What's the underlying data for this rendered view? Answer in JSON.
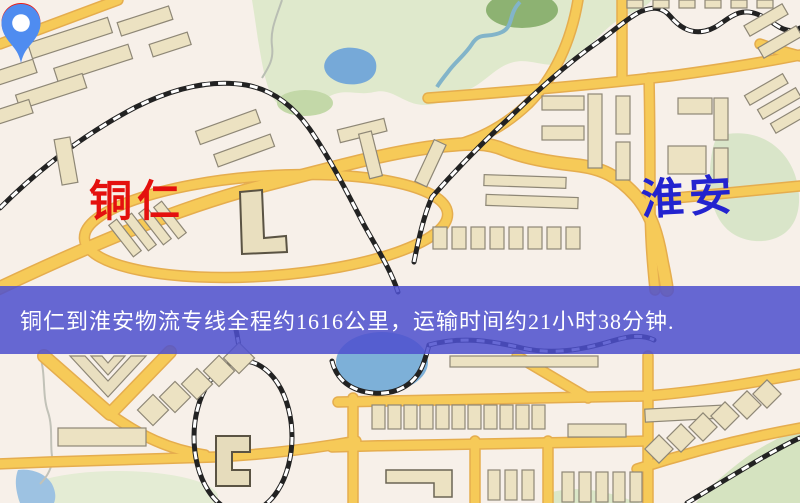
{
  "banner": {
    "text": "铜仁到淮安物流专线全程约1616公里，运输时间约21小时38分钟.",
    "bg_color": "#4e50ce",
    "text_color": "#ffffff"
  },
  "markers": {
    "origin": {
      "label": "铜仁",
      "pin_color": "#ea1c17",
      "label_color": "#e4100e"
    },
    "destination": {
      "label": "淮安",
      "pin_color": "#4f8cf0",
      "label_color": "#2323cf"
    }
  },
  "map_palette": {
    "background": "#f7f0e9",
    "road_fill": "#f6ca58",
    "road_casing": "#e5ad4e",
    "park": "#dfe9cc",
    "water": "#76a9d8",
    "building": "#ece2c2",
    "railway": "#222222"
  }
}
